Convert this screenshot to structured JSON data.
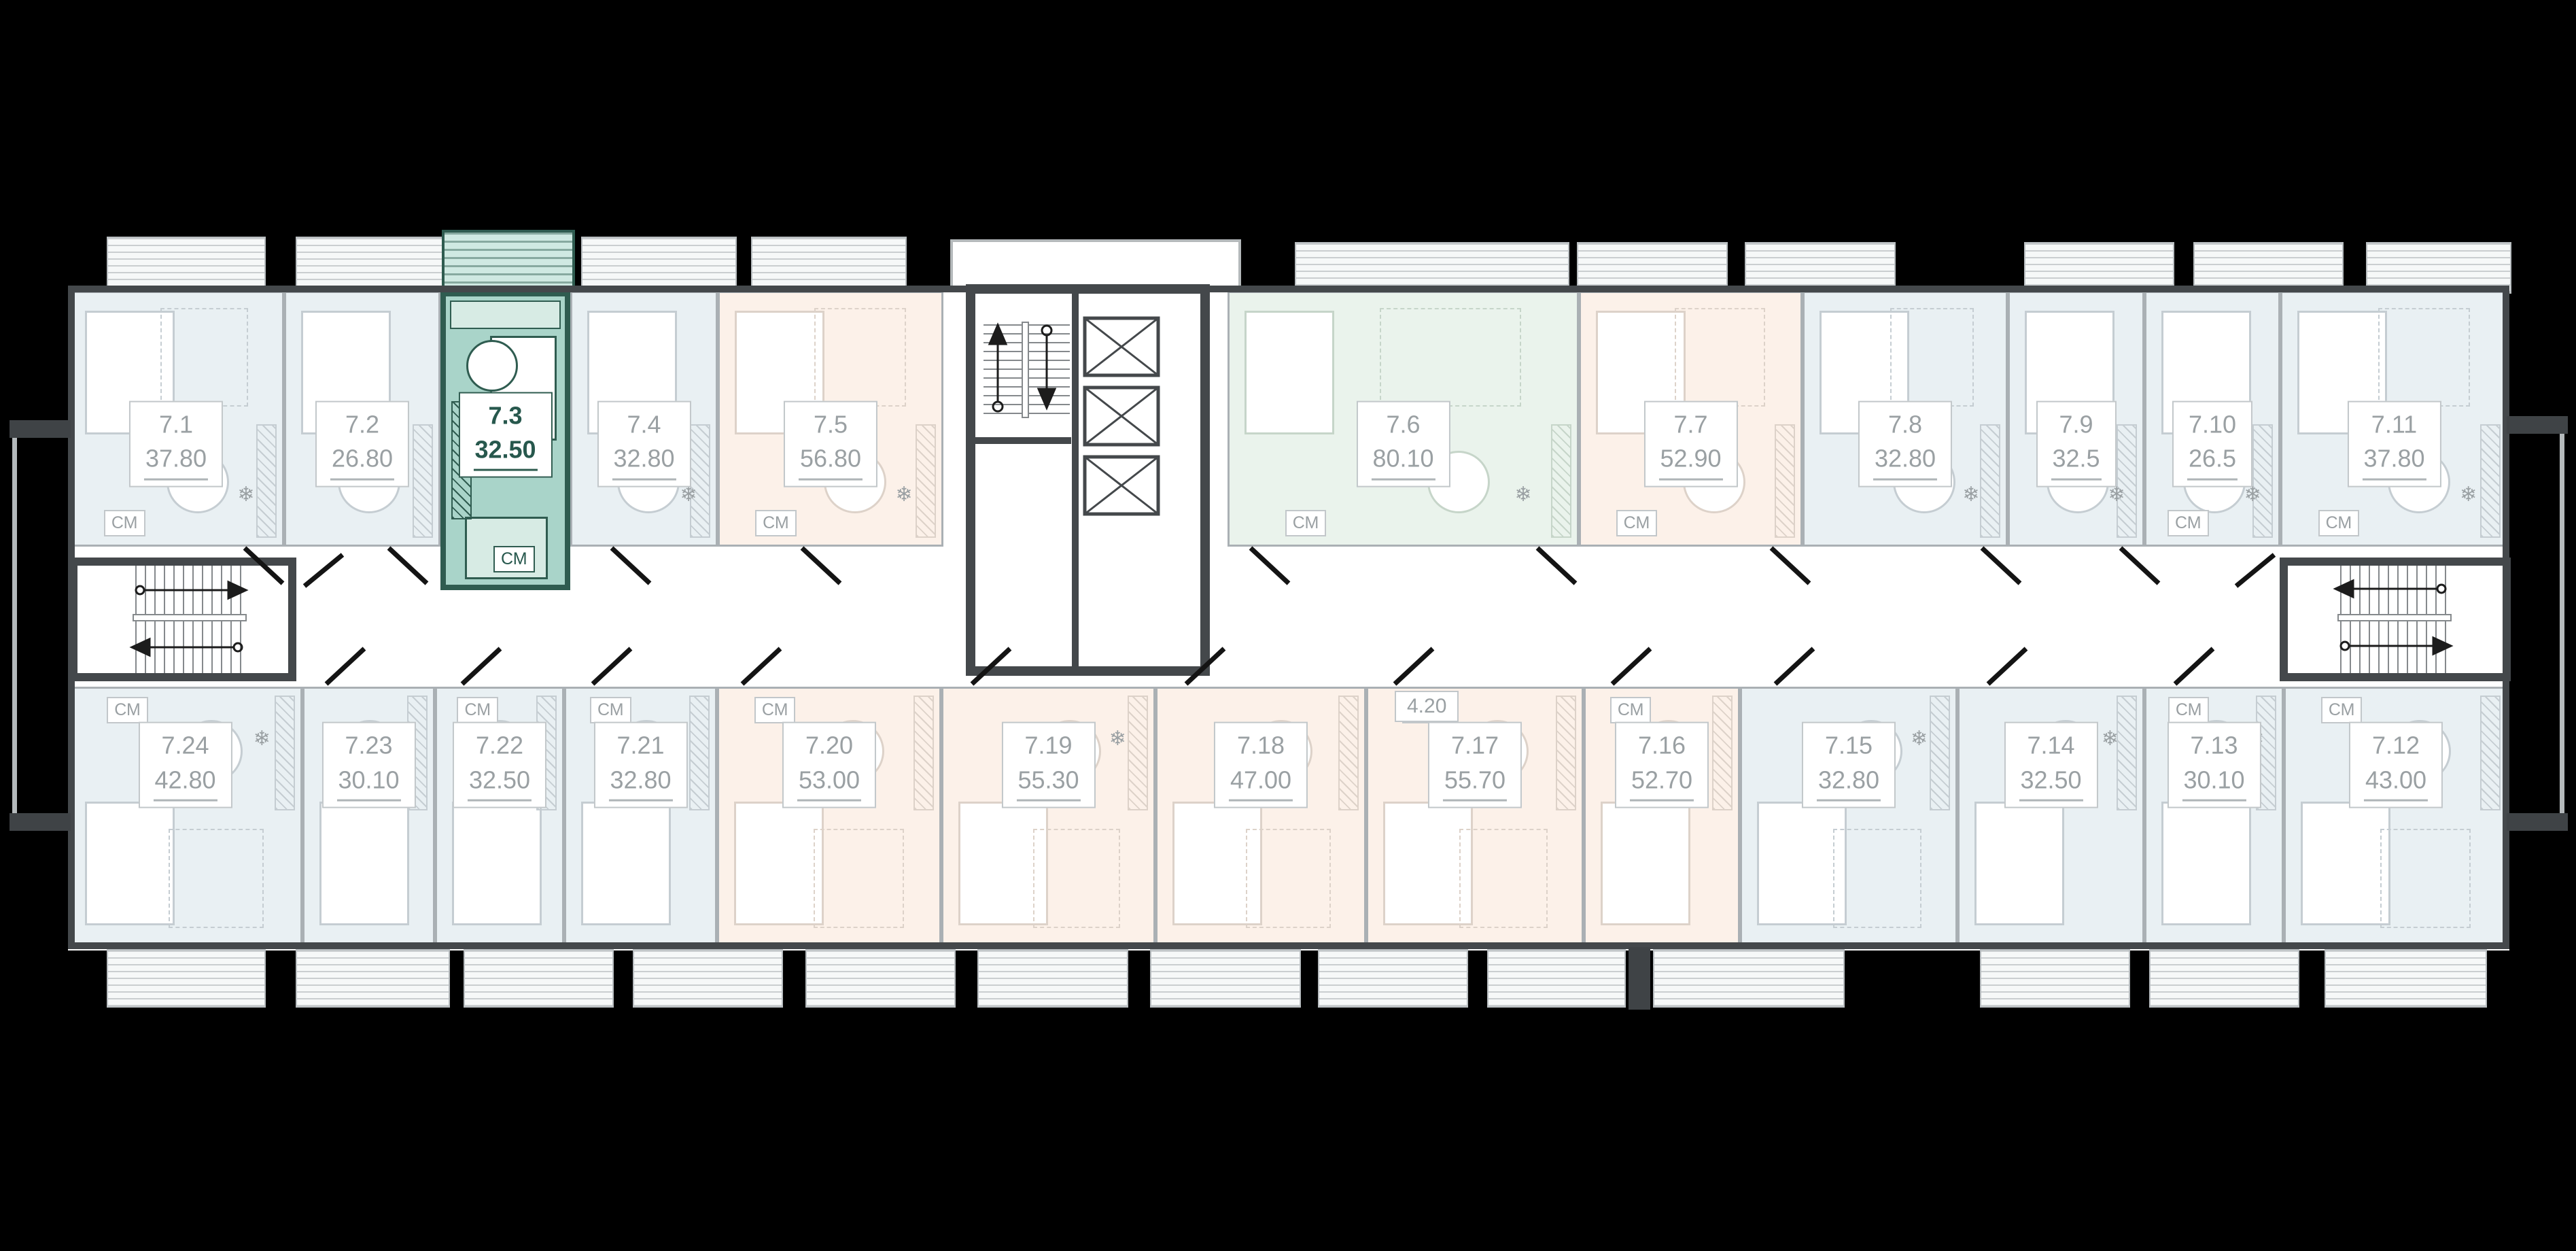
{
  "plan": {
    "building": "floor-plan",
    "highlighted_apartment": "7.3",
    "colors": {
      "background": "#000000",
      "floor": "#ffffff",
      "tint_blue": "#e9f0f3",
      "tint_peach": "#fcf1e9",
      "tint_green": "#eaf3ec",
      "highlight_fill": "#a9d4c9",
      "highlight_wall": "#2f5c50",
      "wall_dark": "#44484b",
      "partition": "#aab0b4",
      "label_text": "#9aa0a3"
    }
  },
  "glyphs": {
    "washing_machine": "СМ",
    "fridge": "❄"
  },
  "apartments": [
    {
      "id": "7.1",
      "area": "37.80",
      "tint": "blue",
      "highlighted": false,
      "cm": true,
      "fridge": true
    },
    {
      "id": "7.2",
      "area": "26.80",
      "tint": "blue",
      "highlighted": false,
      "cm": false,
      "fridge": false
    },
    {
      "id": "7.3",
      "area": "32.50",
      "tint": "teal",
      "highlighted": true,
      "cm": true,
      "fridge": true
    },
    {
      "id": "7.4",
      "area": "32.80",
      "tint": "blue",
      "highlighted": false,
      "cm": false,
      "fridge": true
    },
    {
      "id": "7.5",
      "area": "56.80",
      "tint": "peach",
      "highlighted": false,
      "cm": true,
      "fridge": true
    },
    {
      "id": "7.6",
      "area": "80.10",
      "tint": "green",
      "highlighted": false,
      "cm": true,
      "fridge": true
    },
    {
      "id": "7.7",
      "area": "52.90",
      "tint": "peach",
      "highlighted": false,
      "cm": true,
      "fridge": false
    },
    {
      "id": "7.8",
      "area": "32.80",
      "tint": "blue",
      "highlighted": false,
      "cm": false,
      "fridge": true
    },
    {
      "id": "7.9",
      "area": "32.5",
      "tint": "blue",
      "highlighted": false,
      "cm": false,
      "fridge": true
    },
    {
      "id": "7.10",
      "area": "26.5",
      "tint": "blue",
      "highlighted": false,
      "cm": true,
      "fridge": true
    },
    {
      "id": "7.11",
      "area": "37.80",
      "tint": "blue",
      "highlighted": false,
      "cm": true,
      "fridge": true
    },
    {
      "id": "7.12",
      "area": "43.00",
      "tint": "blue",
      "highlighted": false,
      "cm": true,
      "fridge": false
    },
    {
      "id": "7.13",
      "area": "30.10",
      "tint": "blue",
      "highlighted": false,
      "cm": true,
      "fridge": true
    },
    {
      "id": "7.14",
      "area": "32.50",
      "tint": "blue",
      "highlighted": false,
      "cm": false,
      "fridge": true
    },
    {
      "id": "7.15",
      "area": "32.80",
      "tint": "blue",
      "highlighted": false,
      "cm": false,
      "fridge": true
    },
    {
      "id": "7.16",
      "area": "52.70",
      "tint": "peach",
      "highlighted": false,
      "cm": true,
      "fridge": false
    },
    {
      "id": "7.17",
      "area": "55.70",
      "tint": "peach",
      "highlighted": false,
      "cm": true,
      "fridge": false
    },
    {
      "id": "7.18",
      "area": "47.00",
      "tint": "peach",
      "highlighted": false,
      "cm": false,
      "fridge": false
    },
    {
      "id": "7.19",
      "area": "55.30",
      "tint": "peach",
      "highlighted": false,
      "cm": false,
      "fridge": true
    },
    {
      "id": "7.20",
      "area": "53.00",
      "tint": "peach",
      "highlighted": false,
      "cm": true,
      "fridge": false
    },
    {
      "id": "7.21",
      "area": "32.80",
      "tint": "blue",
      "highlighted": false,
      "cm": true,
      "fridge": false
    },
    {
      "id": "7.22",
      "area": "32.50",
      "tint": "blue",
      "highlighted": false,
      "cm": true,
      "fridge": true
    },
    {
      "id": "7.23",
      "area": "30.10",
      "tint": "blue",
      "highlighted": false,
      "cm": false,
      "fridge": true
    },
    {
      "id": "7.24",
      "area": "42.80",
      "tint": "blue",
      "highlighted": false,
      "cm": true,
      "fridge": true
    }
  ],
  "extra_labels": [
    {
      "text": "4.20"
    }
  ]
}
